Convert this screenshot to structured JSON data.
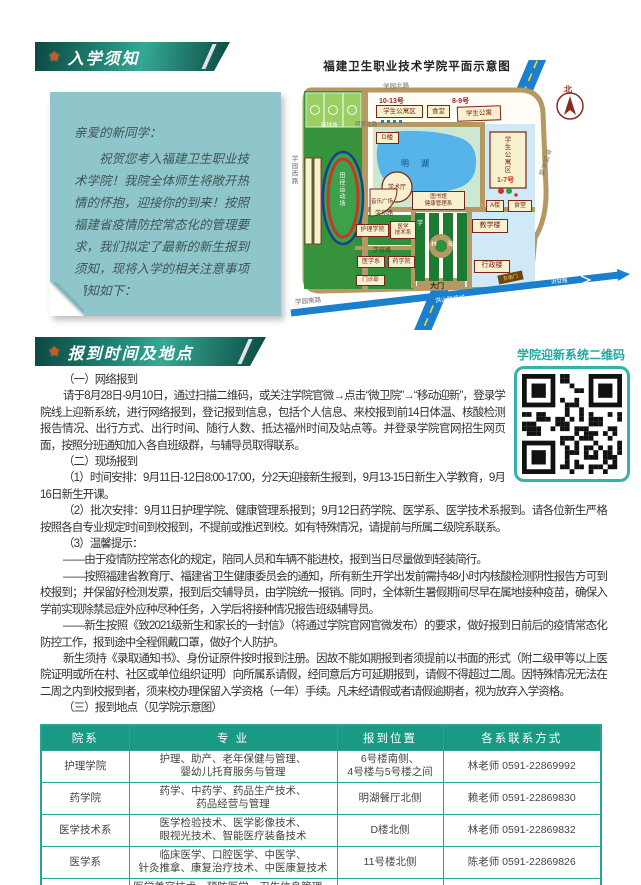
{
  "colors": {
    "banner_teal": "#1d7a6c",
    "accent_teal": "#25a8a0",
    "table_header": "#189a85",
    "note_bg": "#8fc6cb",
    "road_tan": "#b49a62",
    "lake_blue": "#56b4e9",
    "highway_blue": "#1b7fd0"
  },
  "section1": {
    "banner": "入学须知",
    "note": {
      "greeting": "亲爱的新同学：",
      "body": "祝贺您考入福建卫生职业技术学院！我院全体师生将敞开热情的怀抱，迎接你的到来！按照福建省疫情防控常态化的管理要求，我们拟定了最新的新生报到须知，现将入学的相关注意事项通知如下："
    }
  },
  "map": {
    "title": "福建卫生职业技术学院平面示意图",
    "north_label": "北",
    "roads": {
      "north": "学园北路",
      "west": "学园西路",
      "south": "学园南路",
      "east": "学园东路",
      "lake_north": "明湖北路",
      "xueyuan": "学苑路",
      "xuefu": "学府路",
      "ganhong": "甘洪路",
      "south_link": "洪山联络线",
      "link_arrow": "洪甘路"
    },
    "places": {
      "basketball": "篮球场",
      "track": "田径运动场",
      "dorm_nw_no": "10-13号",
      "dorm_nw": "学生公寓区",
      "canteen_n": "食堂",
      "dorm_n_no": "8-9号",
      "dorm_n": "学生公寓",
      "d_bldg": "D楼",
      "lake": "明湖",
      "hall": "学术厅",
      "music_plaza": "音乐广场",
      "library": "图书馆",
      "health_dept": "健康管理系",
      "dorm_e": "学生公寓区",
      "dorm_e_no": "1-7号",
      "a_bldg": "A楼",
      "canteen_e": "食堂",
      "teaching": "教学楼",
      "admin": "行政楼",
      "nursing": "护理学院",
      "medtech_l1": "医学",
      "medtech_l2": "技术系",
      "medical": "医学系",
      "pharmacy": "药学院",
      "clinic": "门诊部",
      "gate": "大门",
      "se_gate": "东南门",
      "blvd_c1": "学",
      "blvd_c2": "林",
      "blvd_c3": "海"
    }
  },
  "section2": {
    "banner": "报到时间及地点",
    "qr_caption": "学院迎新系统二维码",
    "paragraphs": [
      "（一）网络报到",
      "请于8月28日-9月10日，通过扫描二维码，或关注学院官微→点击“微卫院”→“移动迎新”，登录学院线上迎新系统，进行网络报到，登记报到信息，包括个人信息、来校报到前14日体温、核酸检测报告情况、出行方式、出行时间、随行人数、抵达福州时间及站点等。并登录学院官网招生网页面，按照分班通知加入各自班级群，与辅导员取得联系。",
      "（二）现场报到",
      "（1）时间安排：9月11日-12日8:00-17:00，分2天迎接新生报到，9月13-15日新生入学教育，9月16日新生开课。",
      "（2）批次安排：9月11日护理学院、健康管理系报到；9月12日药学院、医学系、医学技术系报到。请各位新生严格按照各自专业规定时间到校报到，不提前或推迟到校。如有特殊情况，请提前与所属二级院系联系。",
      "（3）温馨提示：",
      "——由于疫情防控常态化的规定，陪同人员和车辆不能进校，报到当日尽量做到轻装简行。",
      "——按照福建省教育厅、福建省卫生健康委员会的通知，所有新生开学出发前需持48小时内核酸检测阴性报告方可到校报到；并保留好检测发票，报到后交辅导员，由学院统一报销。同时，全体新生暑假期间尽早在属地接种疫苗，确保入学前实现除禁忌症外应种尽种任务，入学后将接种情况报告班级辅导员。",
      "——新生按照《致2021级新生和家长的一封信》（将通过学院官网官微发布）的要求，做好报到日前后的疫情常态化防控工作，报到途中全程佩戴口罩，做好个人防护。",
      "新生须持《录取通知书》、身份证原件按时报到注册。因故不能如期报到者须提前以书面的形式（附二级甲等以上医院证明或所在村、社区或单位组织证明）向所属系请假，经同意后方可延期报到，请假不得超过二周。因特殊情况无法在二周之内到校报到者，须来校办理保留入学资格（一年）手续。凡未经请假或者请假逾期者，视为放弃入学资格。",
      "（三）报到地点（见学院示意图）"
    ]
  },
  "table": {
    "headers": [
      "院系",
      "专 业",
      "报到位置",
      "各系联系方式"
    ],
    "rows": [
      {
        "dept": "护理学院",
        "majors": "护理、助产、老年保健与管理、\n婴幼儿托育服务与管理",
        "location": "6号楼南侧、\n4号楼与5号楼之间",
        "contact": "林老师 0591-22869992"
      },
      {
        "dept": "药学院",
        "majors": "药学、中药学、药品生产技术、\n药品经营与管理",
        "location": "明湖餐厅北侧",
        "contact": "赖老师 0591-22869830"
      },
      {
        "dept": "医学技术系",
        "majors": "医学检验技术、医学影像技术、\n眼视光技术、智能医疗装备技术",
        "location": "D楼北侧",
        "contact": "林老师 0591-22869832"
      },
      {
        "dept": "医学系",
        "majors": "临床医学、口腔医学、中医学、\n针灸推拿、康复治疗技术、中医康复技术",
        "location": "11号楼北侧",
        "contact": "陈老师 0591-22869826"
      },
      {
        "dept": "健康管理系",
        "majors": "医学美容技术、预防医学、卫生信息管理、\n健康管理、医学营养、体育保健与康复",
        "location": "9号楼西侧",
        "contact": "吴老师 0591-22068711"
      }
    ]
  }
}
